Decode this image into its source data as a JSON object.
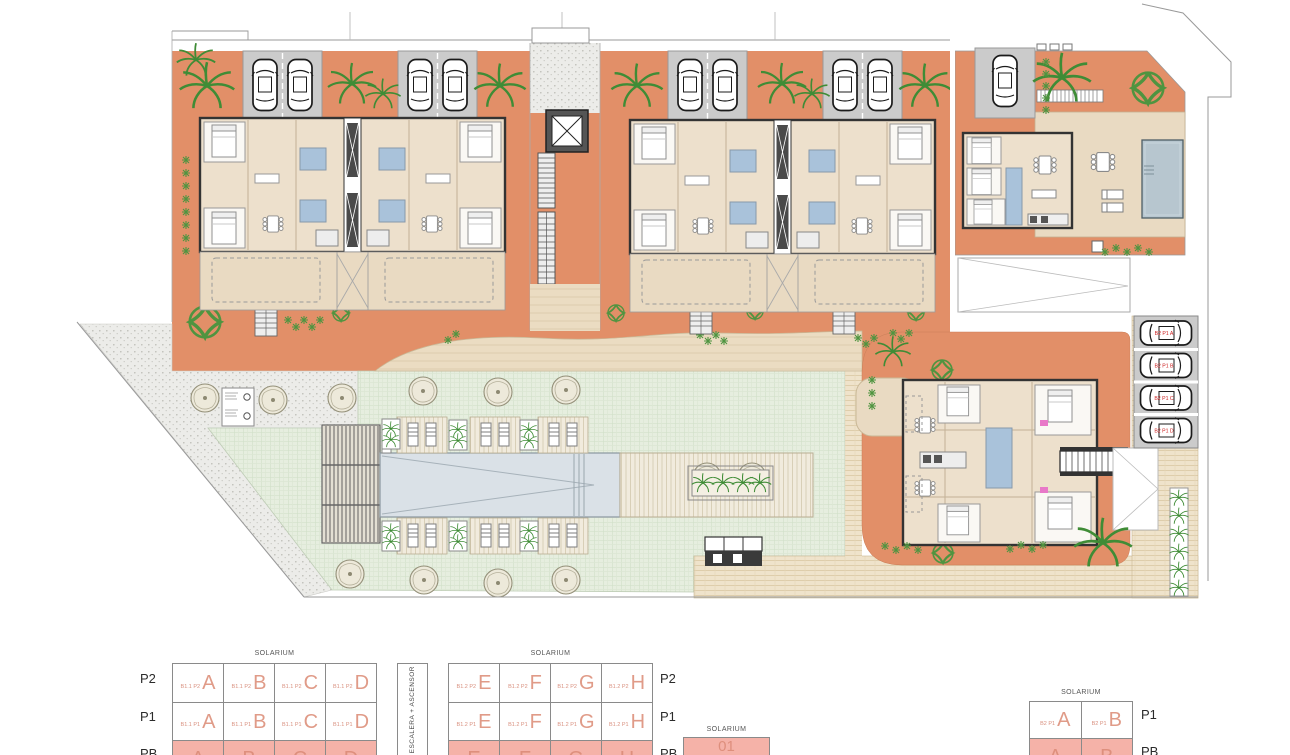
{
  "plan": {
    "parking_labels": [
      "B2 P1 A",
      "B2 P1 B",
      "B2 P1 C",
      "B2 P1 D"
    ]
  },
  "legend": {
    "solarium": "SOLARIUM",
    "escalera": "ESCALERA + ASCENSOR",
    "cell01": "01",
    "blocks": {
      "b11": {
        "rows": [
          {
            "floor": "P2",
            "cells": [
              {
                "p": "B1.1 P2",
                "l": "A"
              },
              {
                "p": "B1.1 P2",
                "l": "B"
              },
              {
                "p": "B1.1 P2",
                "l": "C"
              },
              {
                "p": "B1.1 P2",
                "l": "D"
              }
            ]
          },
          {
            "floor": "P1",
            "cells": [
              {
                "p": "B1.1 P1",
                "l": "A"
              },
              {
                "p": "B1.1 P1",
                "l": "B"
              },
              {
                "p": "B1.1 P1",
                "l": "C"
              },
              {
                "p": "B1.1 P1",
                "l": "D"
              }
            ]
          },
          {
            "floor": "PB",
            "cells": [
              {
                "p": "",
                "l": "A"
              },
              {
                "p": "",
                "l": "B"
              },
              {
                "p": "",
                "l": "C"
              },
              {
                "p": "",
                "l": "D"
              }
            ]
          }
        ]
      },
      "b12": {
        "rows": [
          {
            "floor": "P2",
            "cells": [
              {
                "p": "B1.2 P2",
                "l": "E"
              },
              {
                "p": "B1.2 P2",
                "l": "F"
              },
              {
                "p": "B1.2 P2",
                "l": "G"
              },
              {
                "p": "B1.2 P2",
                "l": "H"
              }
            ]
          },
          {
            "floor": "P1",
            "cells": [
              {
                "p": "B1.2 P1",
                "l": "E"
              },
              {
                "p": "B1.2 P1",
                "l": "F"
              },
              {
                "p": "B1.2 P1",
                "l": "G"
              },
              {
                "p": "B1.2 P1",
                "l": "H"
              }
            ]
          },
          {
            "floor": "PB",
            "cells": [
              {
                "p": "",
                "l": "E"
              },
              {
                "p": "",
                "l": "F"
              },
              {
                "p": "",
                "l": "G"
              },
              {
                "p": "",
                "l": "H"
              }
            ]
          }
        ]
      },
      "b2": {
        "rows": [
          {
            "floor": "P1",
            "cells": [
              {
                "p": "B2 P1",
                "l": "A"
              },
              {
                "p": "B2 P1",
                "l": "B"
              }
            ]
          },
          {
            "floor": "PB",
            "cells": [
              {
                "p": "",
                "l": "A"
              },
              {
                "p": "",
                "l": "B"
              }
            ]
          }
        ]
      }
    }
  },
  "colors": {
    "terrace_orange": "#E28F68",
    "building_beige": "#EDE0CC",
    "highlight_pink": "#F5B2A8",
    "unit_letter_salmon": "#E09B88",
    "parking_label_red": "#CC1F1F",
    "lawn_green": "#E6EEDF",
    "pool_blue": "#DAE1E7",
    "bath_blue": "#A9C2DA"
  }
}
